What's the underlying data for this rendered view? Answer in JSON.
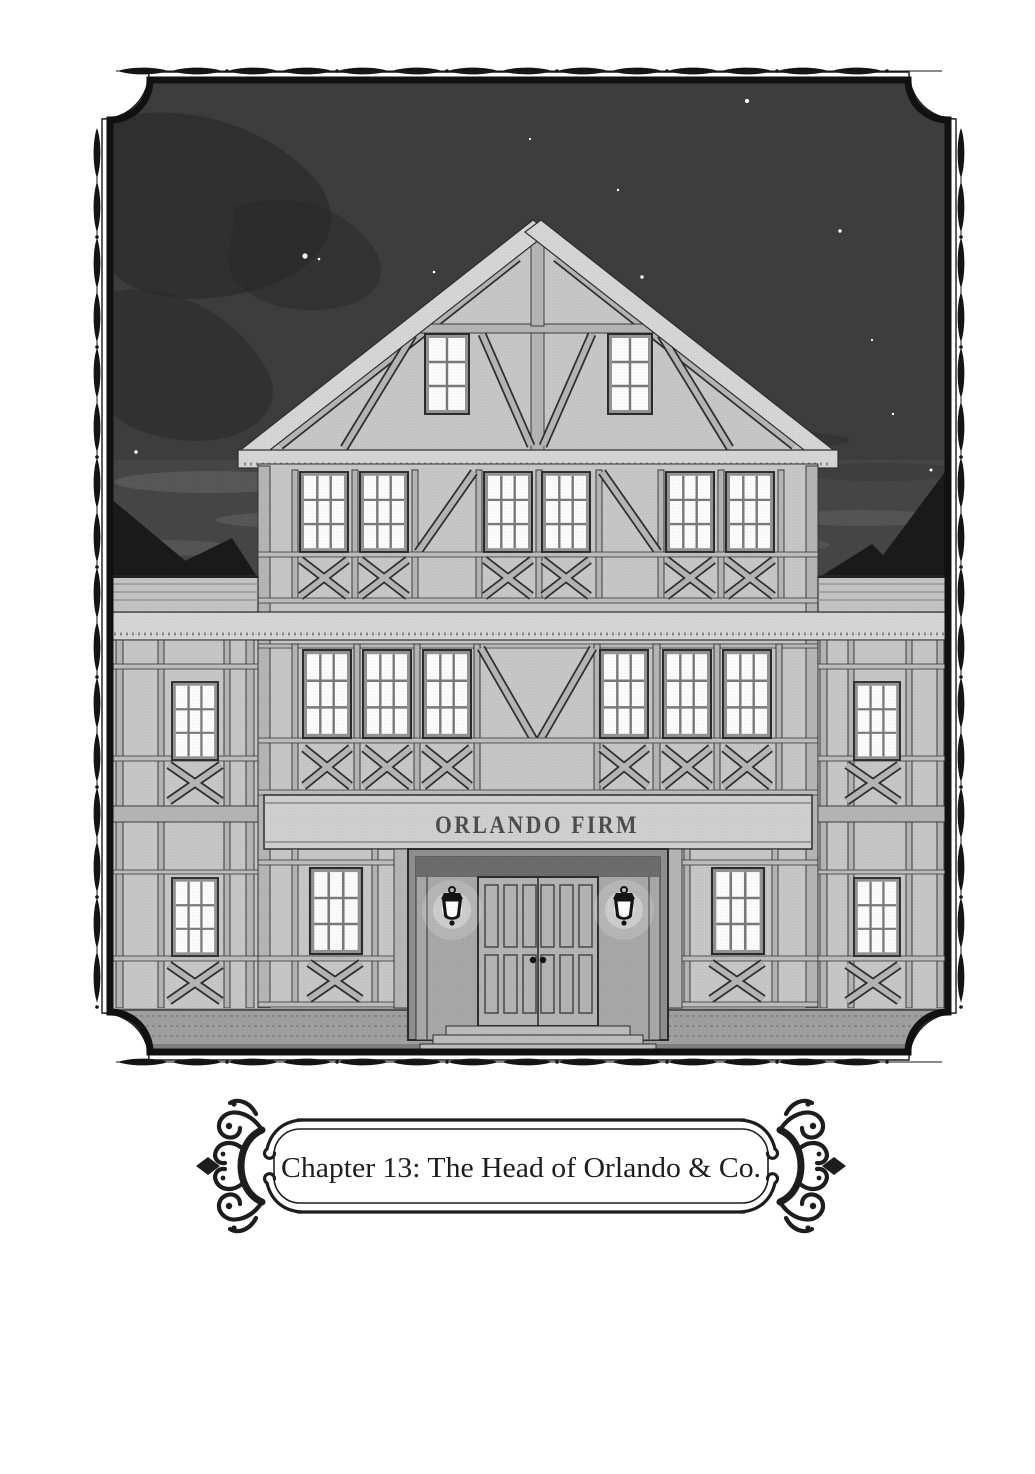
{
  "illustration": {
    "scene": "Half-timbered trading-house building at night under a starry sky",
    "sign_text": "ORLANDO FIRM",
    "building": {
      "gable_windows": 2,
      "third_floor_windows": 6,
      "second_floor_windows": 6,
      "ground_floor_windows": 2,
      "wing_windows": 4,
      "lanterns": 2,
      "entrance_doors": 2
    }
  },
  "caption": {
    "text": "Chapter 13: The Head of Orlando & Co."
  },
  "colors": {
    "sky": "#3d3d3d",
    "frame": "#111111",
    "ink": "#1d1d1d",
    "wall": "#c7c7c7",
    "wall_light": "#d6d6d6",
    "beam": "#b5b5b5",
    "outline": "#2f2f2f",
    "glow": "#fcfcfc",
    "roof": "#1a1a1a",
    "entrance": "#a8a8a8",
    "sign_ink": "#4d4d4d",
    "ground": "#a0a0a0"
  }
}
